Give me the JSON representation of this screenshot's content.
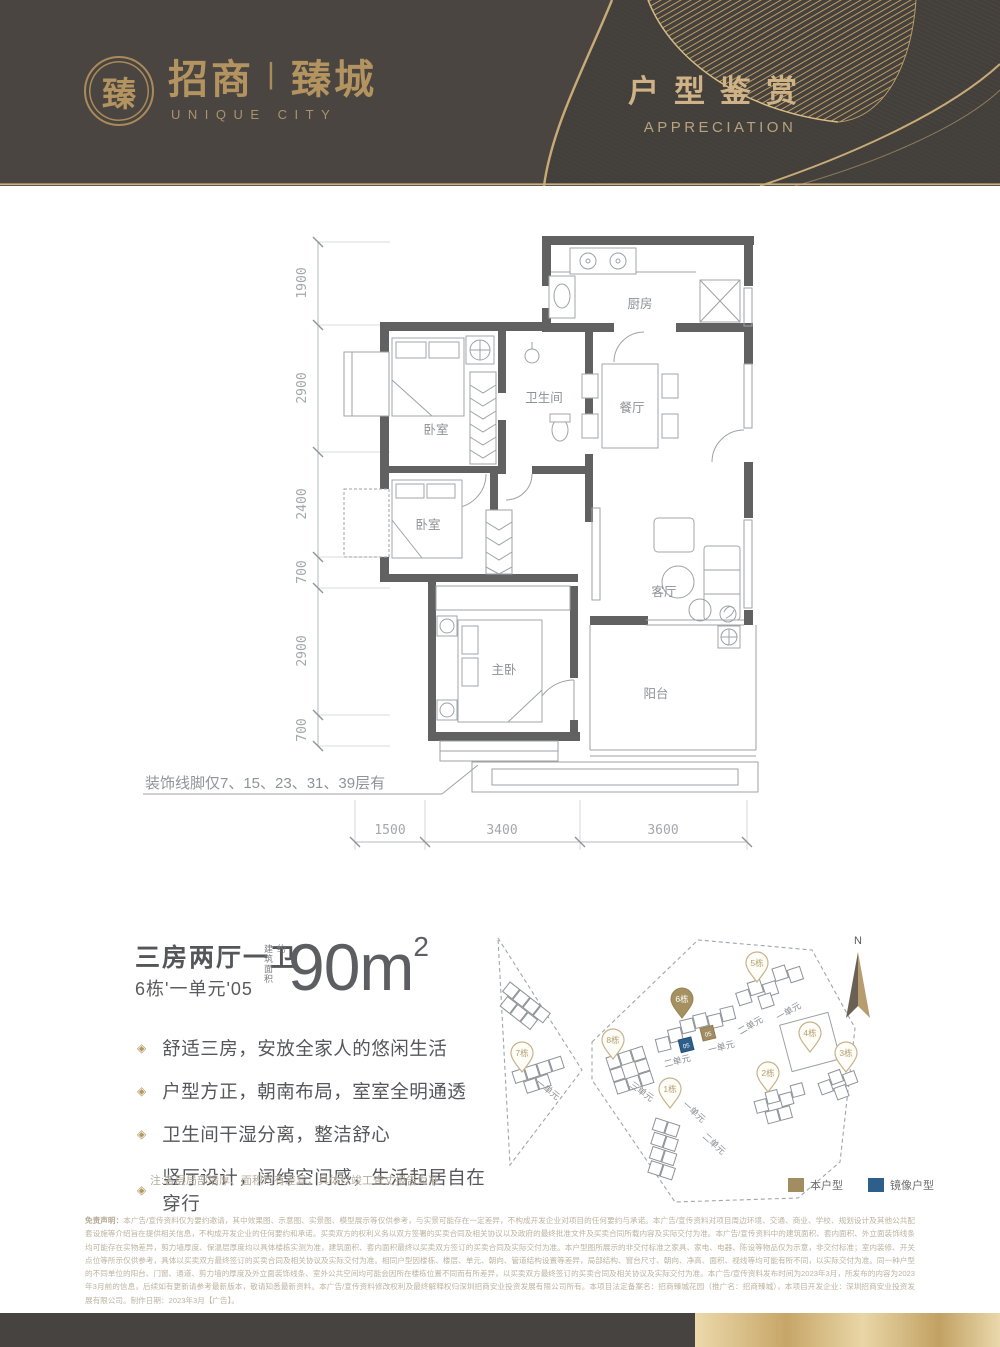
{
  "header": {
    "seal_char": "臻",
    "brand_left": "招商",
    "brand_divider": "丨",
    "brand_right": "臻城",
    "brand_subtitle": "UNIQUE CITY",
    "section_title": "户型鉴赏",
    "section_subtitle": "APPRECIATION"
  },
  "floorplan": {
    "dims_left": [
      "1900",
      "2900",
      "2400",
      "700",
      "2900",
      "700"
    ],
    "dims_bottom": [
      "1500",
      "3400",
      "3600"
    ],
    "rooms": {
      "kitchen": "厨房",
      "bathroom": "卫生间",
      "dining": "餐厅",
      "bedroom_top": "卧室",
      "bedroom_mid": "卧室",
      "master": "主卧",
      "living": "客厅",
      "balcony": "阳台"
    },
    "note": "装饰线脚仅7、15、23、31、39层有"
  },
  "info": {
    "layout_title": "三房两厅一卫",
    "unit_label": "6栋'一单元'05",
    "area_label": "建筑面积约",
    "area_value": "90m",
    "area_sup": "2",
    "features": [
      "舒适三房，安放全家人的悠闲生活",
      "户型方正，朝南布局，室室全明通透",
      "卫生间干湿分离，整洁舒心",
      "竖厅设计，阔绰空间感，生活起居自在穿行"
    ],
    "bullet_glyph": "◈",
    "note": "注:各层局部墙厚、面积均有差异，具体以竣工查丈报告为准"
  },
  "siteplan": {
    "compass": "N",
    "pins": [
      "7栋",
      "8栋",
      "6栋",
      "5栋",
      "4栋",
      "3栋",
      "2栋",
      "1栋"
    ],
    "highlight_unit": "05",
    "mirror_unit": "05",
    "unit_labels": {
      "u1": "一单元",
      "u2": "二单元",
      "u3": "三单元"
    },
    "legend": {
      "self": "本户型",
      "mirror": "镜像户型"
    }
  },
  "disclaimer": {
    "title": "免责声明：",
    "text": "本广告/宣传资料仅为要约邀请，其中效果图、示意图、实景图、模型展示等仅供参考，与实景可能存在一定差异，不构成开发企业对项目的任何要约与承诺。本广告/宣传资料对项目周边环境、交通、商业、学校、规划设计及其他公共配套设施等介绍旨在提供相关信息，不构成开发企业的任何要约和承诺。买卖双方的权利义务以双方签署的买卖合同及相关协议以及政府的最终批准文件及买卖合同所载内容及实际交付为准。本广告/宣传资料中的建筑面积、套内面积、外立面装饰线条均可能存在实物差异，剪力墙厚度、保温层厚度均以具体楼栋实测为准，建筑面积、套内面积最终以买卖双方签订的买卖合同及实际交付为准。本户型图所展示的非交付标准之家具、家电、电器、陈设等物品仅为示意，非交付标准；室内装修、开关点位等所示仅供参考，具体以买卖双方最终签订的买卖合同及相关协议及实际交付为准。相同户型因楼栋、楼层、单元、朝向、管道结构设置等差异，局部结构、窗台尺寸、朝向、净高、面积、视线等均可能有所不同，以实际交付为准。同一种户型的不同单位的阳台、门窗、通道、剪力墙的厚度及外立面装饰线条、室外公共空间均可能会因所在楼栋位置不同而有所差异，以买卖双方最终签订的买卖合同及相关协议及实际交付为准。本广告/宣传资料发布时间为2023年3月，所发布的内容为2023年3月前的信息，后续如有更新请参考最新版本，敬请知悉最新资料。本广告/宣传资料修改权利及最终解释权归深圳招商安业投资发展有限公司所有。本项目法定备案名：招商臻城花园（推广名：招商臻城），本项目开发企业：深圳招商安业投资发展有限公司。制作日期：2023年3月【广告】。"
  },
  "colors": {
    "gold": "#c8ab76",
    "header_bg": "#4a4540",
    "legend_self": "#a28c62",
    "legend_mirror": "#2e5f8a"
  }
}
